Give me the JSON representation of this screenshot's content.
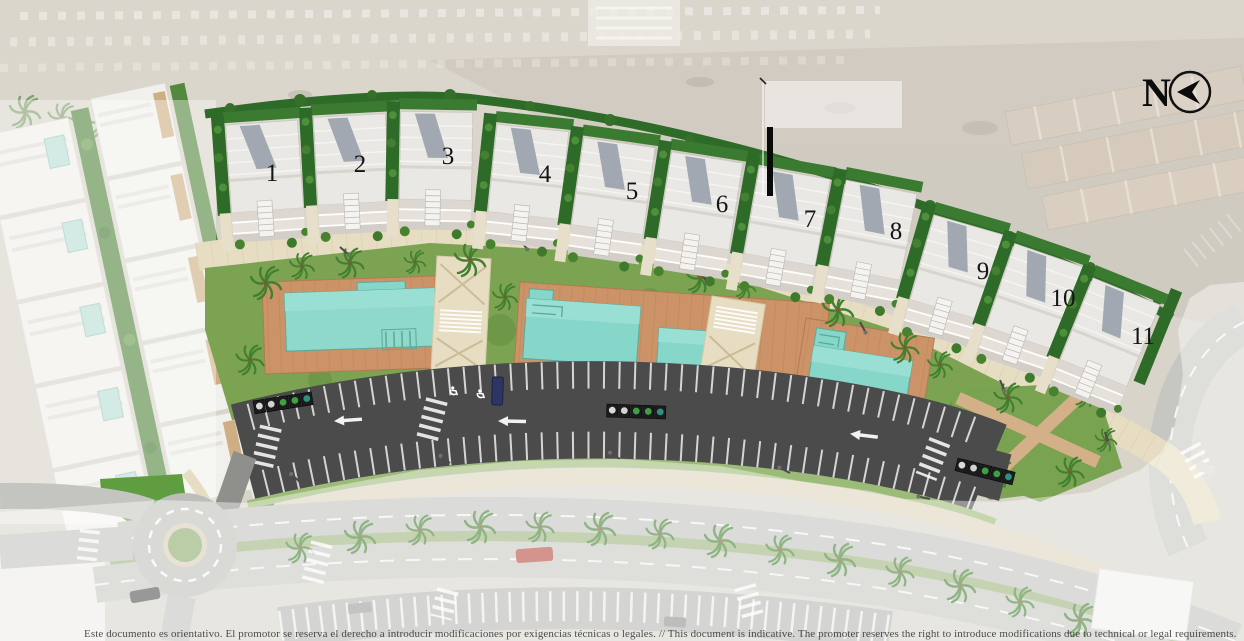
{
  "plan": {
    "north": {
      "label": "N",
      "icon": "compass-arrow-west"
    },
    "houses": {
      "numbers": [
        "1",
        "2",
        "3",
        "4",
        "5",
        "6",
        "7",
        "8",
        "9",
        "10",
        "11"
      ]
    },
    "disclaimer": {
      "text": "Este documento es orientativo. El promotor se reserva el derecho a introducir modificaciones por exigencias técnicas o legales.  //  This document is indicative. The promoter reserves the right to introduce modifications due to technical or legal requirements."
    },
    "icons": {
      "north_arrow": "circle-with-west-pointing-arrow",
      "accessible_parking": "wheelchair-stall-marking",
      "direction_arrow": "left-arrow-road-marking",
      "palm": "palm-tree-top",
      "roundabout": "circular-junction"
    },
    "colors": {
      "lawn": "#7ba352",
      "hedge": "#2f6b28",
      "pool_water": "#8fd8cc",
      "deck_wood": "#cb9367",
      "asphalt": "#4b4b4b",
      "paving": "#e7ddc3",
      "sand": "#d8d4ca",
      "road": "#c1c1bd"
    }
  }
}
